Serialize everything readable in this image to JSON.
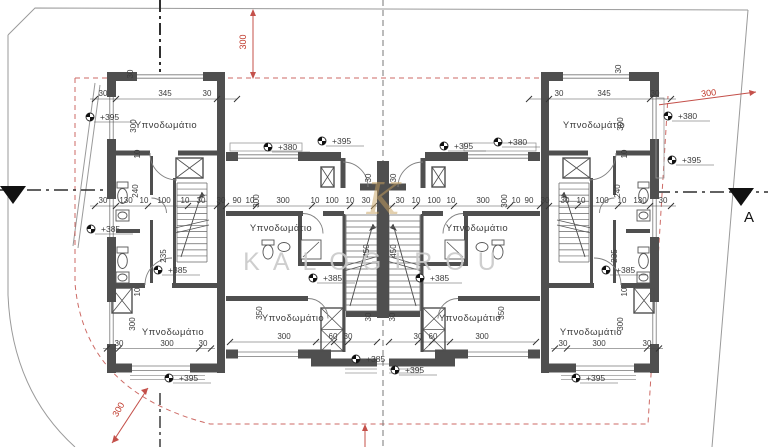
{
  "watermark": {
    "text": "KALOGIROU",
    "logo_letter": "K"
  },
  "section": {
    "label": "A"
  },
  "rooms": {
    "bedroom": "Υπνοδωμάτιο"
  },
  "elevations": {
    "p380": "+380",
    "p385": "+385",
    "p395": "+395"
  },
  "dims": {
    "d10": "10",
    "d30": "30",
    "d60": "60",
    "d90": "90",
    "d100": "100",
    "d130": "130",
    "d235": "235",
    "d240": "240",
    "d300": "300",
    "d345": "345",
    "d350": "350",
    "d450": "450"
  },
  "red_dims": {
    "r300": "300"
  },
  "colors": {
    "wall": "#4f4f4f",
    "red": "#c0392b",
    "boundary": "#9a9a9a",
    "watermark_text": "#c9c9c9",
    "logo_gold": "#c9a25f"
  }
}
